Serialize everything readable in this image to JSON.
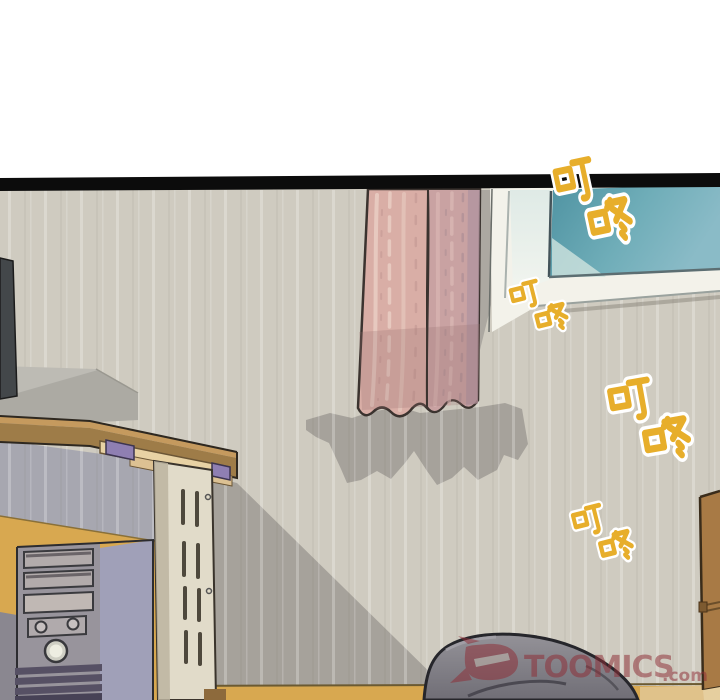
{
  "panel": {
    "alt": "Webtoon panel of an empty room: desk with monitor and computer tower on the left, pink curtain and window on the wall, a doorbell sound effect ringing, gray bean bag at bottom",
    "background": "#ffffff",
    "border_color": "#0d0d0d"
  },
  "sfx": {
    "text": "叮咚",
    "count": 4,
    "fill": "#e7ae2b",
    "halo": "#ffffff"
  },
  "watermark": {
    "name": "TOOMICS",
    "tld": ".com",
    "color": "#8e2d36"
  },
  "palette": {
    "wall": "#cfcbc0",
    "wall_shadow": "#a6a29b",
    "under_desk_shadow": "#a7a7b0",
    "curtain_left": "#d9aea6",
    "curtain_right": "#c9a2a2",
    "window_glass_dark": "#4f93a2",
    "window_glass_light": "#8abbc7",
    "window_frame": "#f3f2ea",
    "desk_top": "#c59a5e",
    "desk_front": "#9e7c48",
    "desk_rail": "#e8d2a4",
    "desk_bracket": "#8f7fb2",
    "desk_leg": "#e1dbc9",
    "wainscot": "#d8a850",
    "tower_front": "#98949c",
    "tower_side": "#a0a0b8",
    "tower_ridges": "#565064",
    "bean_bag": "#8a888e",
    "wardrobe": "#a87a45",
    "monitor_back": "#bdbbb4",
    "monitor_edge": "#43474a"
  }
}
